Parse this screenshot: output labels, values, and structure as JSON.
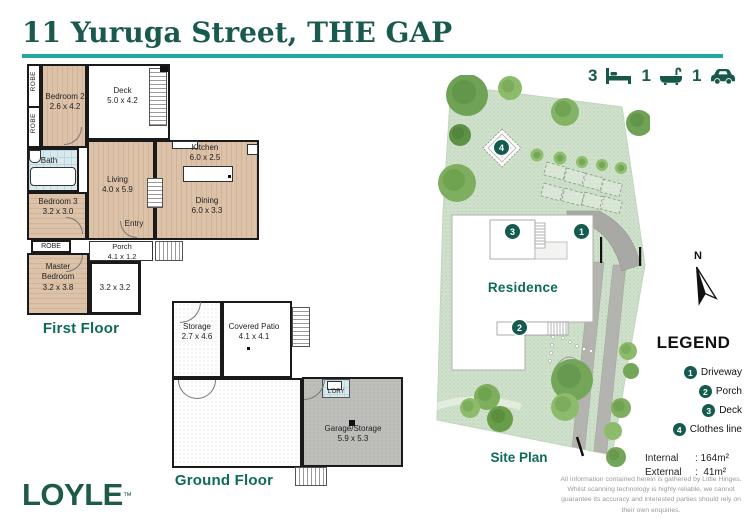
{
  "title": "11 Yuruga Street, THE GAP",
  "stats": {
    "beds": "3",
    "baths": "1",
    "cars": "1"
  },
  "first_floor": {
    "label": "First Floor",
    "bedroom2": {
      "name": "Bedroom 2",
      "dims": "2.6 x 4.2"
    },
    "deck": {
      "name": "Deck",
      "dims": "5.0 x 4.2"
    },
    "kitchen": {
      "name": "Kitchen",
      "dims": "6.0 x 2.5"
    },
    "living": {
      "name": "Living",
      "dims": "4.0 x 5.9"
    },
    "dining": {
      "name": "Dining",
      "dims": "6.0 x 3.3"
    },
    "bath": {
      "name": "Bath"
    },
    "bedroom3": {
      "name": "Bedroom 3",
      "dims": "3.2 x 3.0"
    },
    "entry": {
      "name": "Entry"
    },
    "porch": {
      "name": "Porch",
      "dims": "4.1 x 1.2"
    },
    "master": {
      "name": "Master Bedroom",
      "dims": "3.2 x 3.8"
    },
    "store_room": {
      "dims": "3.2 x 3.2"
    },
    "robe1": "ROBE",
    "robe2": "ROBE",
    "robe3": "ROBE"
  },
  "ground_floor": {
    "label": "Ground Floor",
    "storage": {
      "name": "Storage",
      "dims": "2.7 x 4.6"
    },
    "patio": {
      "name": "Covered Patio",
      "dims": "4.1 x 4.1"
    },
    "laundry": {
      "name": "L'DRY"
    },
    "garage": {
      "name": "Garage/Storage",
      "dims": "5.9 x 5.3"
    }
  },
  "site_plan": {
    "label": "Site Plan",
    "residence": "Residence",
    "north": "N"
  },
  "legend": {
    "title": "LEGEND",
    "items": [
      {
        "num": "1",
        "label": "Driveway"
      },
      {
        "num": "2",
        "label": "Porch"
      },
      {
        "num": "3",
        "label": "Deck"
      },
      {
        "num": "4",
        "label": "Clothes line"
      }
    ],
    "internal": {
      "name": "Internal",
      "value": ": 164m²"
    },
    "external": {
      "name": "External",
      "value": ":  41m²"
    }
  },
  "footer": {
    "logo": "LOYLE",
    "trademark": "™",
    "disclaimer": "All information contained herein is gathered by Little Hinges. Whilst scanning technology is highly reliable, we cannot guarantee its accuracy and interested parties should rely on their own enquiries."
  },
  "colors": {
    "accent_teal": "#27a7a2",
    "heading_green": "#1a5a4e",
    "marker_green": "#155a4e",
    "brand_green": "#1d5b45"
  }
}
